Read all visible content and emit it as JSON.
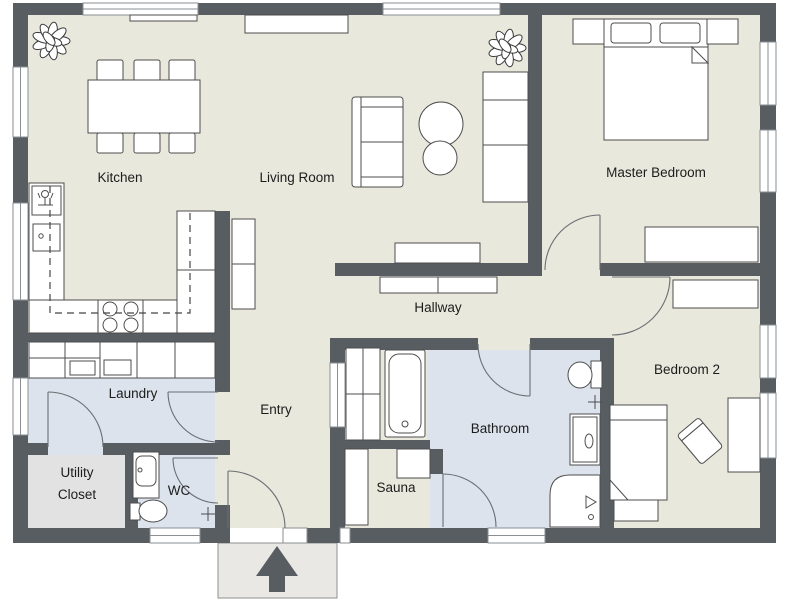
{
  "rooms": [
    {
      "id": "kitchen",
      "name": "Kitchen"
    },
    {
      "id": "living-room",
      "name": "Living Room"
    },
    {
      "id": "master-bedroom",
      "name": "Master Bedroom"
    },
    {
      "id": "hallway",
      "name": "Hallway"
    },
    {
      "id": "laundry",
      "name": "Laundry"
    },
    {
      "id": "entry",
      "name": "Entry"
    },
    {
      "id": "bathroom",
      "name": "Bathroom"
    },
    {
      "id": "sauna",
      "name": "Sauna"
    },
    {
      "id": "wc",
      "name": "WC"
    },
    {
      "id": "utility-closet",
      "name": "Utility Closet",
      "line1": "Utility",
      "line2": "Closet"
    },
    {
      "id": "bedroom-2",
      "name": "Bedroom 2"
    }
  ],
  "icons": {
    "entrance": "entrance-arrow-icon",
    "plant": "potted-plant-icon",
    "faucet": "tap-cross-icon",
    "shower": "shower-head-icon"
  },
  "colors": {
    "wall": "#585d61",
    "floor": "#e9e8dd",
    "wet": "#dce3ed",
    "utility": "#e2e2e2",
    "window_frame": "#8a8f93",
    "furniture_stroke": "#4d4d4d",
    "label": "#1c1c1c"
  }
}
